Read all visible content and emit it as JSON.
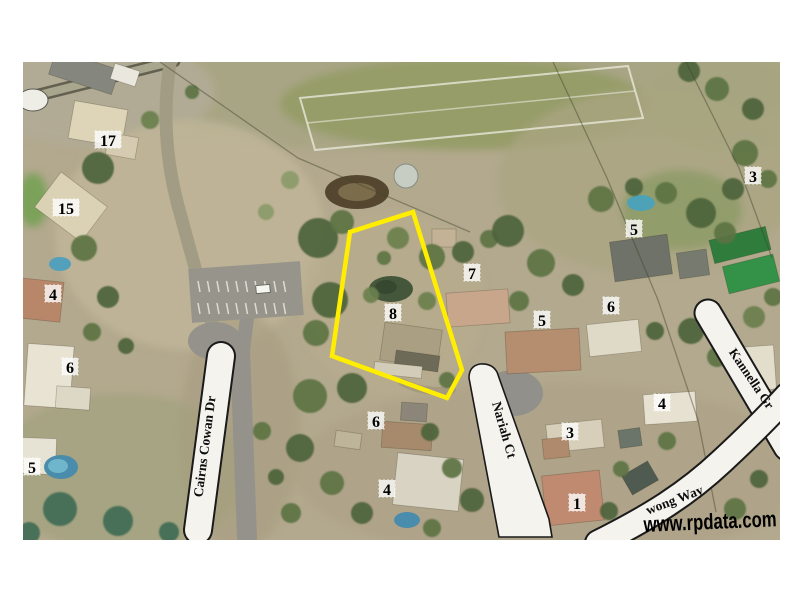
{
  "watermark": {
    "text": "www.rpdata.com",
    "color": "#000000"
  },
  "map": {
    "x": 23,
    "y": 62,
    "width": 757,
    "height": 478,
    "base_color": "#b3a98e",
    "road_fill": "#f4f3ee",
    "road_casing": "#1a1a1a",
    "highlight_color": "#ffee00"
  },
  "parcel_highlight": {
    "points": "350,232 413,212 462,370 447,398 332,356",
    "stroke_width": 4.5
  },
  "street_labels": [
    {
      "text": "Cairns Cowan Dr",
      "x": 209,
      "y": 447,
      "angle": -82.5,
      "size": 13.5
    },
    {
      "text": "Nariah Ct",
      "x": 500,
      "y": 431,
      "angle": 74,
      "size": 13.5
    },
    {
      "text": "Kannella Gr",
      "x": 748,
      "y": 381,
      "angle": 56,
      "size": 13
    },
    {
      "text": "wong Way",
      "x": 676,
      "y": 504,
      "angle": -21,
      "size": 13.5
    }
  ],
  "lot_numbers": [
    {
      "text": "17",
      "x": 108,
      "y": 140
    },
    {
      "text": "15",
      "x": 66,
      "y": 208
    },
    {
      "text": "4",
      "x": 53,
      "y": 294
    },
    {
      "text": "6",
      "x": 70,
      "y": 367
    },
    {
      "text": "5",
      "x": 32,
      "y": 467
    },
    {
      "text": "7",
      "x": 472,
      "y": 273
    },
    {
      "text": "8",
      "x": 393,
      "y": 313
    },
    {
      "text": "5",
      "x": 634,
      "y": 229
    },
    {
      "text": "3",
      "x": 753,
      "y": 176
    },
    {
      "text": "6",
      "x": 611,
      "y": 306
    },
    {
      "text": "5",
      "x": 542,
      "y": 320
    },
    {
      "text": "4",
      "x": 662,
      "y": 403
    },
    {
      "text": "3",
      "x": 570,
      "y": 432
    },
    {
      "text": "1",
      "x": 577,
      "y": 503
    },
    {
      "text": "6",
      "x": 376,
      "y": 421
    },
    {
      "text": "4",
      "x": 387,
      "y": 489
    }
  ],
  "scenery": {
    "palette": {
      "A": "#3f5233",
      "B": "#4d6339",
      "C": "#5b7343",
      "D": "#6a7f4d",
      "T": "#3f6b55",
      "L": "#8b9a68"
    },
    "patches": [
      [
        400,
        88,
        420,
        62,
        "#a8a584",
        1
      ],
      [
        465,
        104,
        185,
        46,
        "#969d69",
        1
      ],
      [
        95,
        92,
        120,
        55,
        "#b1ab96",
        0.9
      ],
      [
        190,
        235,
        135,
        115,
        "#c0b598",
        0.85
      ],
      [
        392,
        302,
        92,
        92,
        "#b9ad8d",
        0.6
      ],
      [
        648,
        182,
        150,
        92,
        "#a9a581",
        0.75
      ],
      [
        552,
        472,
        258,
        88,
        "#aca085",
        0.6
      ],
      [
        122,
        472,
        128,
        78,
        "#9aa078",
        0.55
      ],
      [
        732,
        102,
        88,
        50,
        "#a7a580",
        0.7
      ],
      [
        33,
        200,
        15,
        27,
        "#79a157",
        0.95
      ],
      [
        682,
        210,
        60,
        40,
        "#8c9a66",
        0.8
      ],
      [
        240,
        430,
        60,
        120,
        "#a79d80",
        0.6
      ]
    ],
    "field_outline": "300,98 628,66 643,118 315,150",
    "field_midline": "M 307,123 L 635,91",
    "grey_roads": [
      {
        "d": "M 23,99 L 174,61",
        "w": 13,
        "c": "#62604f"
      },
      {
        "d": "M 23,99 L 174,61",
        "w": 8,
        "c": "#a9a68e"
      },
      {
        "d": "M 170,64 Q 158,140 182,220 Q 198,280 212,324",
        "w": 13,
        "c": "#a39c85"
      },
      {
        "d": "M 247,318 L 243,350",
        "w": 14,
        "c": "#94928a"
      },
      {
        "d": "M 240,350 L 247,537",
        "w": 20,
        "c": "#94928a"
      },
      {
        "d": "M 452,390 Q 424,394 402,382",
        "w": 8,
        "c": "#a59a7f"
      }
    ],
    "grey_ellipses": [
      [
        215,
        341,
        27,
        19,
        "#94928a"
      ],
      [
        513,
        393,
        30,
        23,
        "#91908a"
      ]
    ],
    "parking": {
      "cx": 246,
      "cy": 292,
      "w": 112,
      "h": 54,
      "rot": -4,
      "fill": "#97958b",
      "rows": [
        281,
        303
      ],
      "x0": 198,
      "x1": 292,
      "step": 9.5,
      "dash_len": 11,
      "car": {
        "cx": 263,
        "cy": 289,
        "w": 14,
        "h": 8,
        "rot": -5
      }
    },
    "buildings": [
      [
        84,
        72,
        66,
        26,
        18,
        "#85867e"
      ],
      [
        125,
        75,
        26,
        16,
        18,
        "#e9e7de"
      ],
      [
        98,
        124,
        54,
        38,
        10,
        "#ded4b8"
      ],
      [
        122,
        146,
        30,
        22,
        10,
        "#d5cbb0"
      ],
      [
        71,
        207,
        58,
        44,
        37,
        "#dbd2b6"
      ],
      [
        40,
        300,
        44,
        40,
        6,
        "#b8876a"
      ],
      [
        49,
        376,
        46,
        62,
        4,
        "#e8e3d3"
      ],
      [
        73,
        398,
        34,
        22,
        4,
        "#ddd7c5"
      ],
      [
        36,
        456,
        40,
        36,
        2,
        "#e6e2d4"
      ],
      [
        411,
        345,
        58,
        38,
        8,
        "#ab9f83"
      ],
      [
        417,
        361,
        44,
        16,
        8,
        "#6e6a58"
      ],
      [
        398,
        370,
        48,
        12,
        6,
        "#d2ccb8"
      ],
      [
        478,
        308,
        62,
        34,
        -4,
        "#c7a68c"
      ],
      [
        444,
        238,
        24,
        18,
        0,
        "#c3b295"
      ],
      [
        543,
        351,
        74,
        42,
        -3,
        "#b58d6f"
      ],
      [
        641,
        258,
        58,
        40,
        -8,
        "#6f7268"
      ],
      [
        693,
        264,
        30,
        26,
        -8,
        "#777a6f"
      ],
      [
        740,
        245,
        58,
        24,
        -14,
        "#2f7c3c"
      ],
      [
        751,
        274,
        52,
        28,
        -14,
        "#339247"
      ],
      [
        614,
        338,
        52,
        32,
        -6,
        "#dfd9c7"
      ],
      [
        760,
        368,
        30,
        44,
        -4,
        "#e3ddcc"
      ],
      [
        670,
        408,
        52,
        30,
        -4,
        "#e7e1d1"
      ],
      [
        575,
        436,
        56,
        28,
        -6,
        "#d8cfba"
      ],
      [
        556,
        448,
        26,
        20,
        -6,
        "#b08a6c"
      ],
      [
        573,
        498,
        58,
        50,
        -6,
        "#bf8a70"
      ],
      [
        407,
        436,
        50,
        26,
        4,
        "#a78a6c"
      ],
      [
        414,
        412,
        26,
        18,
        4,
        "#8b8679"
      ],
      [
        428,
        482,
        66,
        52,
        6,
        "#d9d3c3"
      ],
      [
        630,
        438,
        22,
        18,
        -8,
        "#6c756a"
      ],
      [
        640,
        478,
        30,
        22,
        -30,
        "#4f5a50"
      ],
      [
        348,
        440,
        26,
        16,
        8,
        "#bdb49a"
      ]
    ],
    "features": [
      [
        357,
        192,
        32,
        17,
        "#55472f",
        null
      ],
      [
        357,
        192,
        19,
        9,
        "#7b6c4c",
        null
      ],
      [
        406,
        176,
        12,
        12,
        "#c7cdc3",
        "#878c83"
      ],
      [
        33,
        100,
        15,
        11,
        "#efeee6",
        "#5a5a52"
      ],
      [
        391,
        289,
        22,
        13,
        "#45573b",
        null
      ],
      [
        386,
        287,
        11,
        7,
        "#374830",
        null
      ],
      [
        641,
        203,
        14,
        8,
        "#4da2b8",
        null
      ],
      [
        60,
        264,
        11,
        7,
        "#53a0bd",
        null
      ],
      [
        61,
        467,
        17,
        12,
        "#4a8cab",
        null
      ],
      [
        58,
        466,
        10,
        7,
        "#6fb6cc",
        null
      ],
      [
        407,
        520,
        13,
        8,
        "#4a8cab",
        null
      ]
    ],
    "trees": [
      [
        98,
        168,
        16,
        "B"
      ],
      [
        84,
        248,
        13,
        "C"
      ],
      [
        108,
        297,
        11,
        "B"
      ],
      [
        92,
        332,
        9,
        "C"
      ],
      [
        126,
        346,
        8,
        "B"
      ],
      [
        150,
        120,
        9,
        "D"
      ],
      [
        192,
        92,
        7,
        "C"
      ],
      [
        290,
        180,
        9,
        "L"
      ],
      [
        266,
        212,
        8,
        "L"
      ],
      [
        318,
        238,
        20,
        "B"
      ],
      [
        342,
        222,
        12,
        "C"
      ],
      [
        330,
        300,
        18,
        "B"
      ],
      [
        316,
        333,
        13,
        "C"
      ],
      [
        352,
        388,
        15,
        "B"
      ],
      [
        310,
        396,
        17,
        "C"
      ],
      [
        300,
        448,
        14,
        "B"
      ],
      [
        332,
        483,
        12,
        "C"
      ],
      [
        362,
        513,
        11,
        "B"
      ],
      [
        398,
        238,
        11,
        "D"
      ],
      [
        432,
        257,
        13,
        "C"
      ],
      [
        463,
        252,
        11,
        "B"
      ],
      [
        489,
        239,
        9,
        "C"
      ],
      [
        427,
        301,
        9,
        "D"
      ],
      [
        447,
        380,
        8,
        "C"
      ],
      [
        430,
        432,
        9,
        "B"
      ],
      [
        452,
        468,
        10,
        "C"
      ],
      [
        472,
        500,
        12,
        "B"
      ],
      [
        432,
        528,
        9,
        "C"
      ],
      [
        508,
        231,
        16,
        "B"
      ],
      [
        541,
        263,
        14,
        "C"
      ],
      [
        573,
        285,
        11,
        "B"
      ],
      [
        519,
        301,
        10,
        "C"
      ],
      [
        601,
        199,
        13,
        "C"
      ],
      [
        634,
        187,
        9,
        "B"
      ],
      [
        666,
        193,
        11,
        "C"
      ],
      [
        701,
        213,
        15,
        "B"
      ],
      [
        725,
        233,
        11,
        "C"
      ],
      [
        689,
        71,
        11,
        "B"
      ],
      [
        717,
        89,
        12,
        "C"
      ],
      [
        753,
        109,
        11,
        "B"
      ],
      [
        745,
        153,
        13,
        "C"
      ],
      [
        733,
        189,
        11,
        "B"
      ],
      [
        768,
        179,
        9,
        "C"
      ],
      [
        754,
        317,
        11,
        "D"
      ],
      [
        773,
        297,
        9,
        "C"
      ],
      [
        691,
        331,
        13,
        "B"
      ],
      [
        717,
        357,
        10,
        "C"
      ],
      [
        655,
        331,
        9,
        "B"
      ],
      [
        667,
        441,
        9,
        "C"
      ],
      [
        701,
        479,
        13,
        "B"
      ],
      [
        735,
        509,
        11,
        "C"
      ],
      [
        759,
        479,
        9,
        "B"
      ],
      [
        621,
        469,
        8,
        "C"
      ],
      [
        609,
        511,
        9,
        "B"
      ],
      [
        517,
        475,
        8,
        "C"
      ],
      [
        60,
        509,
        17,
        "T"
      ],
      [
        118,
        521,
        15,
        "T"
      ],
      [
        29,
        533,
        11,
        "T"
      ],
      [
        169,
        532,
        10,
        "T"
      ],
      [
        262,
        431,
        9,
        "C"
      ],
      [
        276,
        477,
        8,
        "B"
      ],
      [
        291,
        513,
        10,
        "C"
      ],
      [
        371,
        295,
        8,
        "D"
      ],
      [
        384,
        258,
        7,
        "C"
      ]
    ],
    "power_lines": [
      "M 160,62 L 298,158 L 470,232",
      "M 553,62 L 607,178 L 658,300 L 698,420 L 716,512",
      "M 686,62 L 739,168 L 772,258"
    ],
    "white_roads": [
      {
        "d": "M 221,356 L 198,530",
        "cw": 30,
        "w": 26
      },
      {
        "d": "M 708,313 L 787,447",
        "cw": 29,
        "w": 25
      },
      {
        "d": "M 598,543 C 652,516 688,493 722,461 C 750,435 768,417 787,396",
        "cw": 28,
        "w": 24
      }
    ],
    "nariah_road_path": "M 469,378 Q 469,366 480,364 Q 492,363 497,372 L 549,519 L 552,537 L 499,537 Z"
  }
}
